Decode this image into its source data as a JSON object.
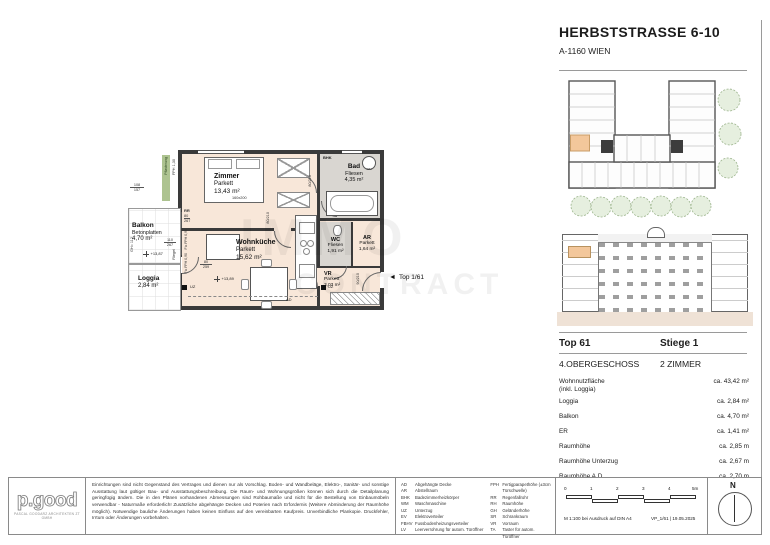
{
  "colors": {
    "room_fill": "#f8e7d9",
    "wet_fill": "#d9d6d1",
    "wall": "#3a3a3a",
    "highlight": "#f3c79b",
    "pflasterung_green": "#adc390",
    "ground": "#efe2d6",
    "tree": "#e6efdf"
  },
  "header": {
    "title": "HERBSTSTRASSE 6-10",
    "subtitle": "A-1160 WIEN"
  },
  "unit": {
    "top": "Top 61",
    "stiege": "Stiege 1",
    "floor": "4.OBERGESCHOSS",
    "type": "2 ZIMMER",
    "wnf_label": "Wohnnutzfläche",
    "wnf_label2": "(inkl. Loggia)",
    "wnf_value": "ca. 43,42 m²",
    "metrics": [
      {
        "label": "Loggia",
        "value": "ca. 2,84 m²"
      },
      {
        "label": "Balkon",
        "value": "ca. 4,70 m²"
      },
      {
        "label": "ER",
        "value": "ca. 1,41 m²"
      },
      {
        "label": "Raumhöhe",
        "value": "ca. 2,85 m"
      },
      {
        "label": "Raumhöhe Unterzug",
        "value": "ca. 2,67 m"
      },
      {
        "label": "Raumhöhe A.D.",
        "value": "ca. 2,70 m"
      }
    ]
  },
  "plan": {
    "zimmer": {
      "name": "Zimmer",
      "floor": "Parkett",
      "area": "13,43 m²"
    },
    "wohnkueche": {
      "name": "Wohnküche",
      "floor": "Parkett",
      "area": "15,62 m²"
    },
    "bad": {
      "name": "Bad",
      "floor": "Fliesen",
      "area": "4,35 m²"
    },
    "wc": {
      "name": "WC",
      "floor": "Fliesen",
      "area": "1,91 m²"
    },
    "ar": {
      "name": "AR",
      "floor": "Parkett",
      "area": "1,64 m²"
    },
    "vr": {
      "name": "VR",
      "floor": "Parkett",
      "area": "3,03 m²"
    },
    "balkon": {
      "name": "Balkon",
      "floor": "Betonplatten",
      "area": "4,70 m²"
    },
    "loggia": {
      "name": "Loggia",
      "area": "2,84 m²"
    },
    "ann": {
      "bed_size": "160x200",
      "entrance": "Top 1/61",
      "level_balkon": "+13,87",
      "level_wohnkueche": "+13,89",
      "gh": "GH= 112",
      "pflasterung": "Pflasterung",
      "riegel": "Riegel",
      "fph130": "FPH 1,30",
      "fix1": "Fix FPH 0,90",
      "fix2": "Fix FPH 0,90",
      "rr": "RR",
      "uz1": "UZ",
      "uz2": "UZ",
      "ad": "AD",
      "bhk": "BHK",
      "wm": "WM",
      "d1a": "108",
      "d1b": "157",
      "d2a": "80",
      "d2b": "267",
      "d3a": "110",
      "d3b": "267",
      "d4a": "80",
      "d4b": "259",
      "door1": "80/210",
      "door2": "80/210",
      "door3": "90/210"
    },
    "watermark1": "IMMO",
    "watermark2": "CONTRACT"
  },
  "footer": {
    "logo": "p.good",
    "logo_sub": "PASCAL GOODARZ ARCHITEKTEN ZT GMBH",
    "disclaimer": "Einrichtungen sind nicht Gegenstand des Vertrages und dienen nur als Vorschlag. Boden- und Wandbeläge, Elektro-, Sanitär- und sonstige Ausstattung laut gültiger Bau- und Ausstattungsbeschreibung. Die Raum- und Wohnungsgrößen können sich durch die Detailplanung geringfügig ändern. Die in den Plänen vorhandenen Abmessungen sind Rohbaumaße und nicht für die Bestellung von Einbaumöbeln verwendbar - Naturmaße erforderlich! Zusätzliche abgehängte Decken und Poterien nach Erfordernis (Weitere Abminderung der Raumhöhe möglich). Notwendige bauliche Änderungen haben keinen Einfluss auf den vereinbarten Kaufpreis. Unverbindliche Plankopie. Druckfehler, Irrtum oder Änderungen vorbehalten.",
    "legend_left": [
      {
        "abbr": "AD",
        "text": "Abgehängte Decke"
      },
      {
        "abbr": "AR",
        "text": "Abstellraum"
      },
      {
        "abbr": "BHK",
        "text": "Badezimmerheizkörper"
      },
      {
        "abbr": "WM",
        "text": "Waschmaschine"
      },
      {
        "abbr": "UZ",
        "text": "Unterzug"
      },
      {
        "abbr": "EV",
        "text": "Elektroverteiler"
      },
      {
        "abbr": "FBHV",
        "text": "Fussbodenheizungsverteiler"
      },
      {
        "abbr": "LV",
        "text": "Leerverrohrung für autom. Türöffner"
      }
    ],
    "legend_right": [
      {
        "abbr": "FPH",
        "text": "Fertigparapethöhe (±3cm Türschwelle)"
      },
      {
        "abbr": "RR",
        "text": "Regenfallrohr"
      },
      {
        "abbr": "RH",
        "text": "Raumhöhe"
      },
      {
        "abbr": "GH",
        "text": "Geländerhöhe"
      },
      {
        "abbr": "SR",
        "text": "Schrankraum"
      },
      {
        "abbr": "VR",
        "text": "Vorraum"
      },
      {
        "abbr": "TA",
        "text": "Taster für autom. Türöffner"
      }
    ],
    "scale_ticks": [
      "0",
      "1",
      "2",
      "3",
      "4",
      "5m"
    ],
    "scale_note": "M 1:100 bei Ausdruck auf DIN A4",
    "scale_doc": "VP_1/61 | 19.05.2025",
    "north": "N"
  }
}
